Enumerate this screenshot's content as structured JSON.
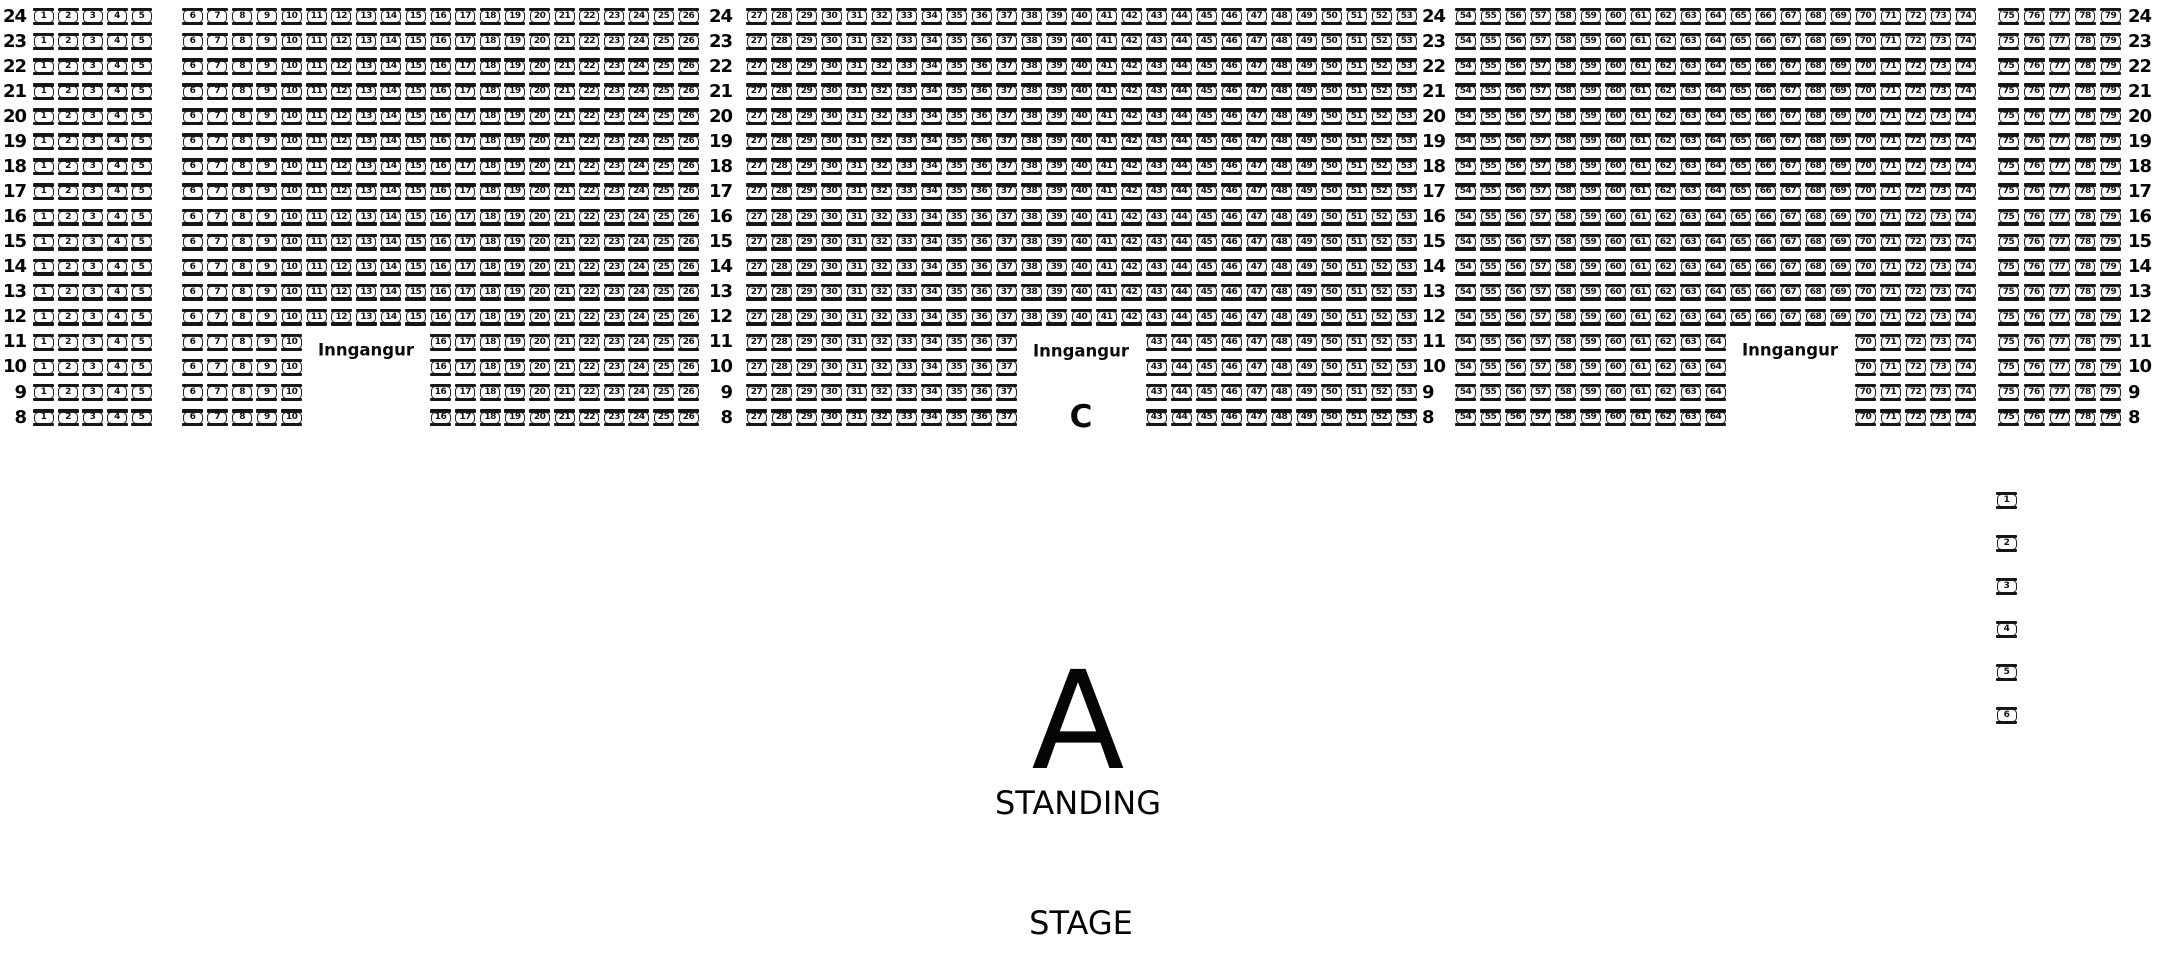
{
  "labels": {
    "entrance": "Inngangur",
    "section_c": "C",
    "section_a": "A",
    "standing": "STANDING",
    "stage": "STAGE"
  },
  "rows": {
    "first": 24,
    "last": 8
  },
  "row_label_columns": [
    {
      "name": "left-edge",
      "x": 26,
      "align": "right"
    },
    {
      "name": "between-26-27",
      "x": 732,
      "align": "right"
    },
    {
      "name": "between-53-54",
      "x": 1422,
      "align": "left"
    },
    {
      "name": "right-edge",
      "x": 2128,
      "align": "left"
    }
  ],
  "seat_blocks": [
    {
      "seats_from": 1,
      "seats_to": 5,
      "x": 33,
      "pitch": 24.5,
      "row_from": 24,
      "row_to": 8
    },
    {
      "seats_from": 6,
      "seats_to": 10,
      "x": 182,
      "pitch": 24.8,
      "row_from": 24,
      "row_to": 8
    },
    {
      "seats_from": 11,
      "seats_to": 15,
      "x": 306,
      "pitch": 24.8,
      "row_from": 24,
      "row_to": 12
    },
    {
      "seats_from": 16,
      "seats_to": 26,
      "x": 430,
      "pitch": 24.8,
      "row_from": 24,
      "row_to": 8
    },
    {
      "seats_from": 27,
      "seats_to": 37,
      "x": 746,
      "pitch": 25.0,
      "row_from": 24,
      "row_to": 8
    },
    {
      "seats_from": 38,
      "seats_to": 42,
      "x": 1021,
      "pitch": 25.0,
      "row_from": 24,
      "row_to": 12
    },
    {
      "seats_from": 43,
      "seats_to": 53,
      "x": 1146,
      "pitch": 25.0,
      "row_from": 24,
      "row_to": 8
    },
    {
      "seats_from": 54,
      "seats_to": 64,
      "x": 1455,
      "pitch": 25.0,
      "row_from": 24,
      "row_to": 8
    },
    {
      "seats_from": 65,
      "seats_to": 69,
      "x": 1730,
      "pitch": 25.0,
      "row_from": 24,
      "row_to": 12
    },
    {
      "seats_from": 70,
      "seats_to": 74,
      "x": 1855,
      "pitch": 25.0,
      "row_from": 24,
      "row_to": 8
    },
    {
      "seats_from": 75,
      "seats_to": 79,
      "x": 1998,
      "pitch": 25.5,
      "row_from": 24,
      "row_to": 8
    }
  ],
  "entrance_positions": [
    {
      "x": 366,
      "y": 350
    },
    {
      "x": 1081,
      "y": 351
    },
    {
      "x": 1790,
      "y": 350
    }
  ],
  "section_c_position": {
    "x": 1081,
    "y": 417
  },
  "section_a_position": {
    "x": 1078,
    "y": 722
  },
  "standing_position": {
    "x": 1078,
    "y": 803
  },
  "stage_position": {
    "x": 1081,
    "y": 923
  },
  "side_seats": {
    "numbers": [
      1,
      2,
      3,
      4,
      5,
      6
    ],
    "x": 1996,
    "tops": [
      492,
      535,
      578,
      621,
      664,
      707
    ]
  },
  "geometry": {
    "row_top_start": 8,
    "row_pitch": 25.07,
    "seat_height": 17
  },
  "colors": {
    "ink": "#111111",
    "background": "#ffffff"
  }
}
